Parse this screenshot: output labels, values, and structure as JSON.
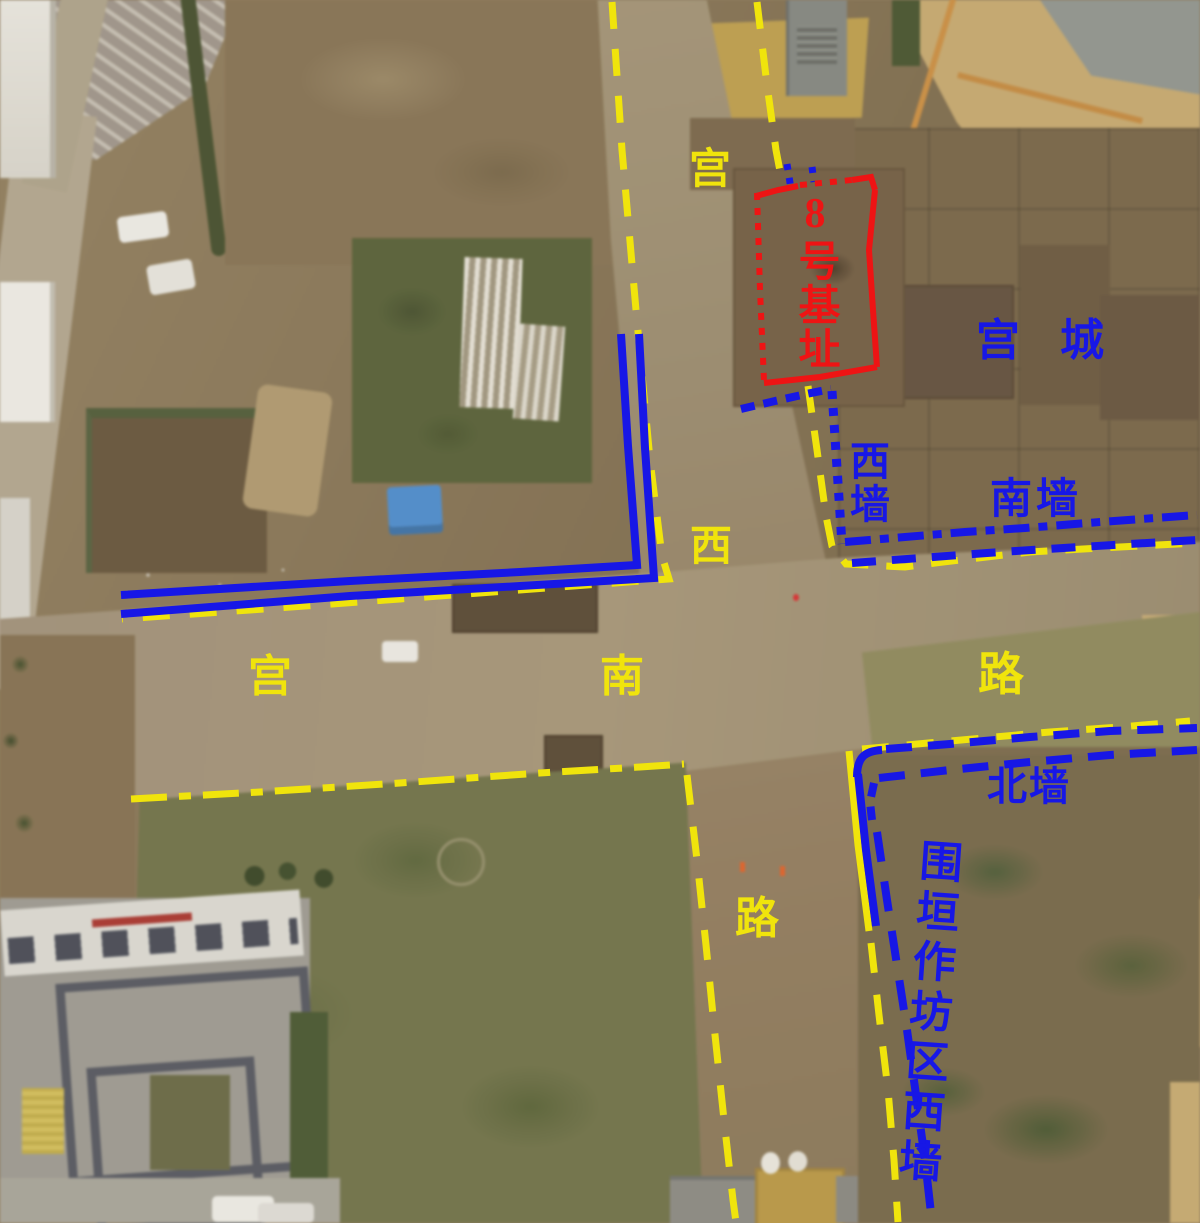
{
  "colors": {
    "road_annotation": "#f0e40c",
    "wall_annotation": "#1717e6",
    "foundation_annotation": "#ee1414",
    "tarp_blue": "#4f8fd0"
  },
  "labels": {
    "palace_west_road": {
      "chars": [
        "宫",
        "西",
        "路"
      ]
    },
    "palace_south_road": {
      "chars": [
        "宫",
        "南",
        "路"
      ]
    },
    "palace_city": "宫城",
    "foundation_no8": "8号基址",
    "west_wall": "西墙",
    "south_wall": "南墙",
    "north_wall": "北墙",
    "workshop_west_wall": "围垣作坊区西墙"
  }
}
